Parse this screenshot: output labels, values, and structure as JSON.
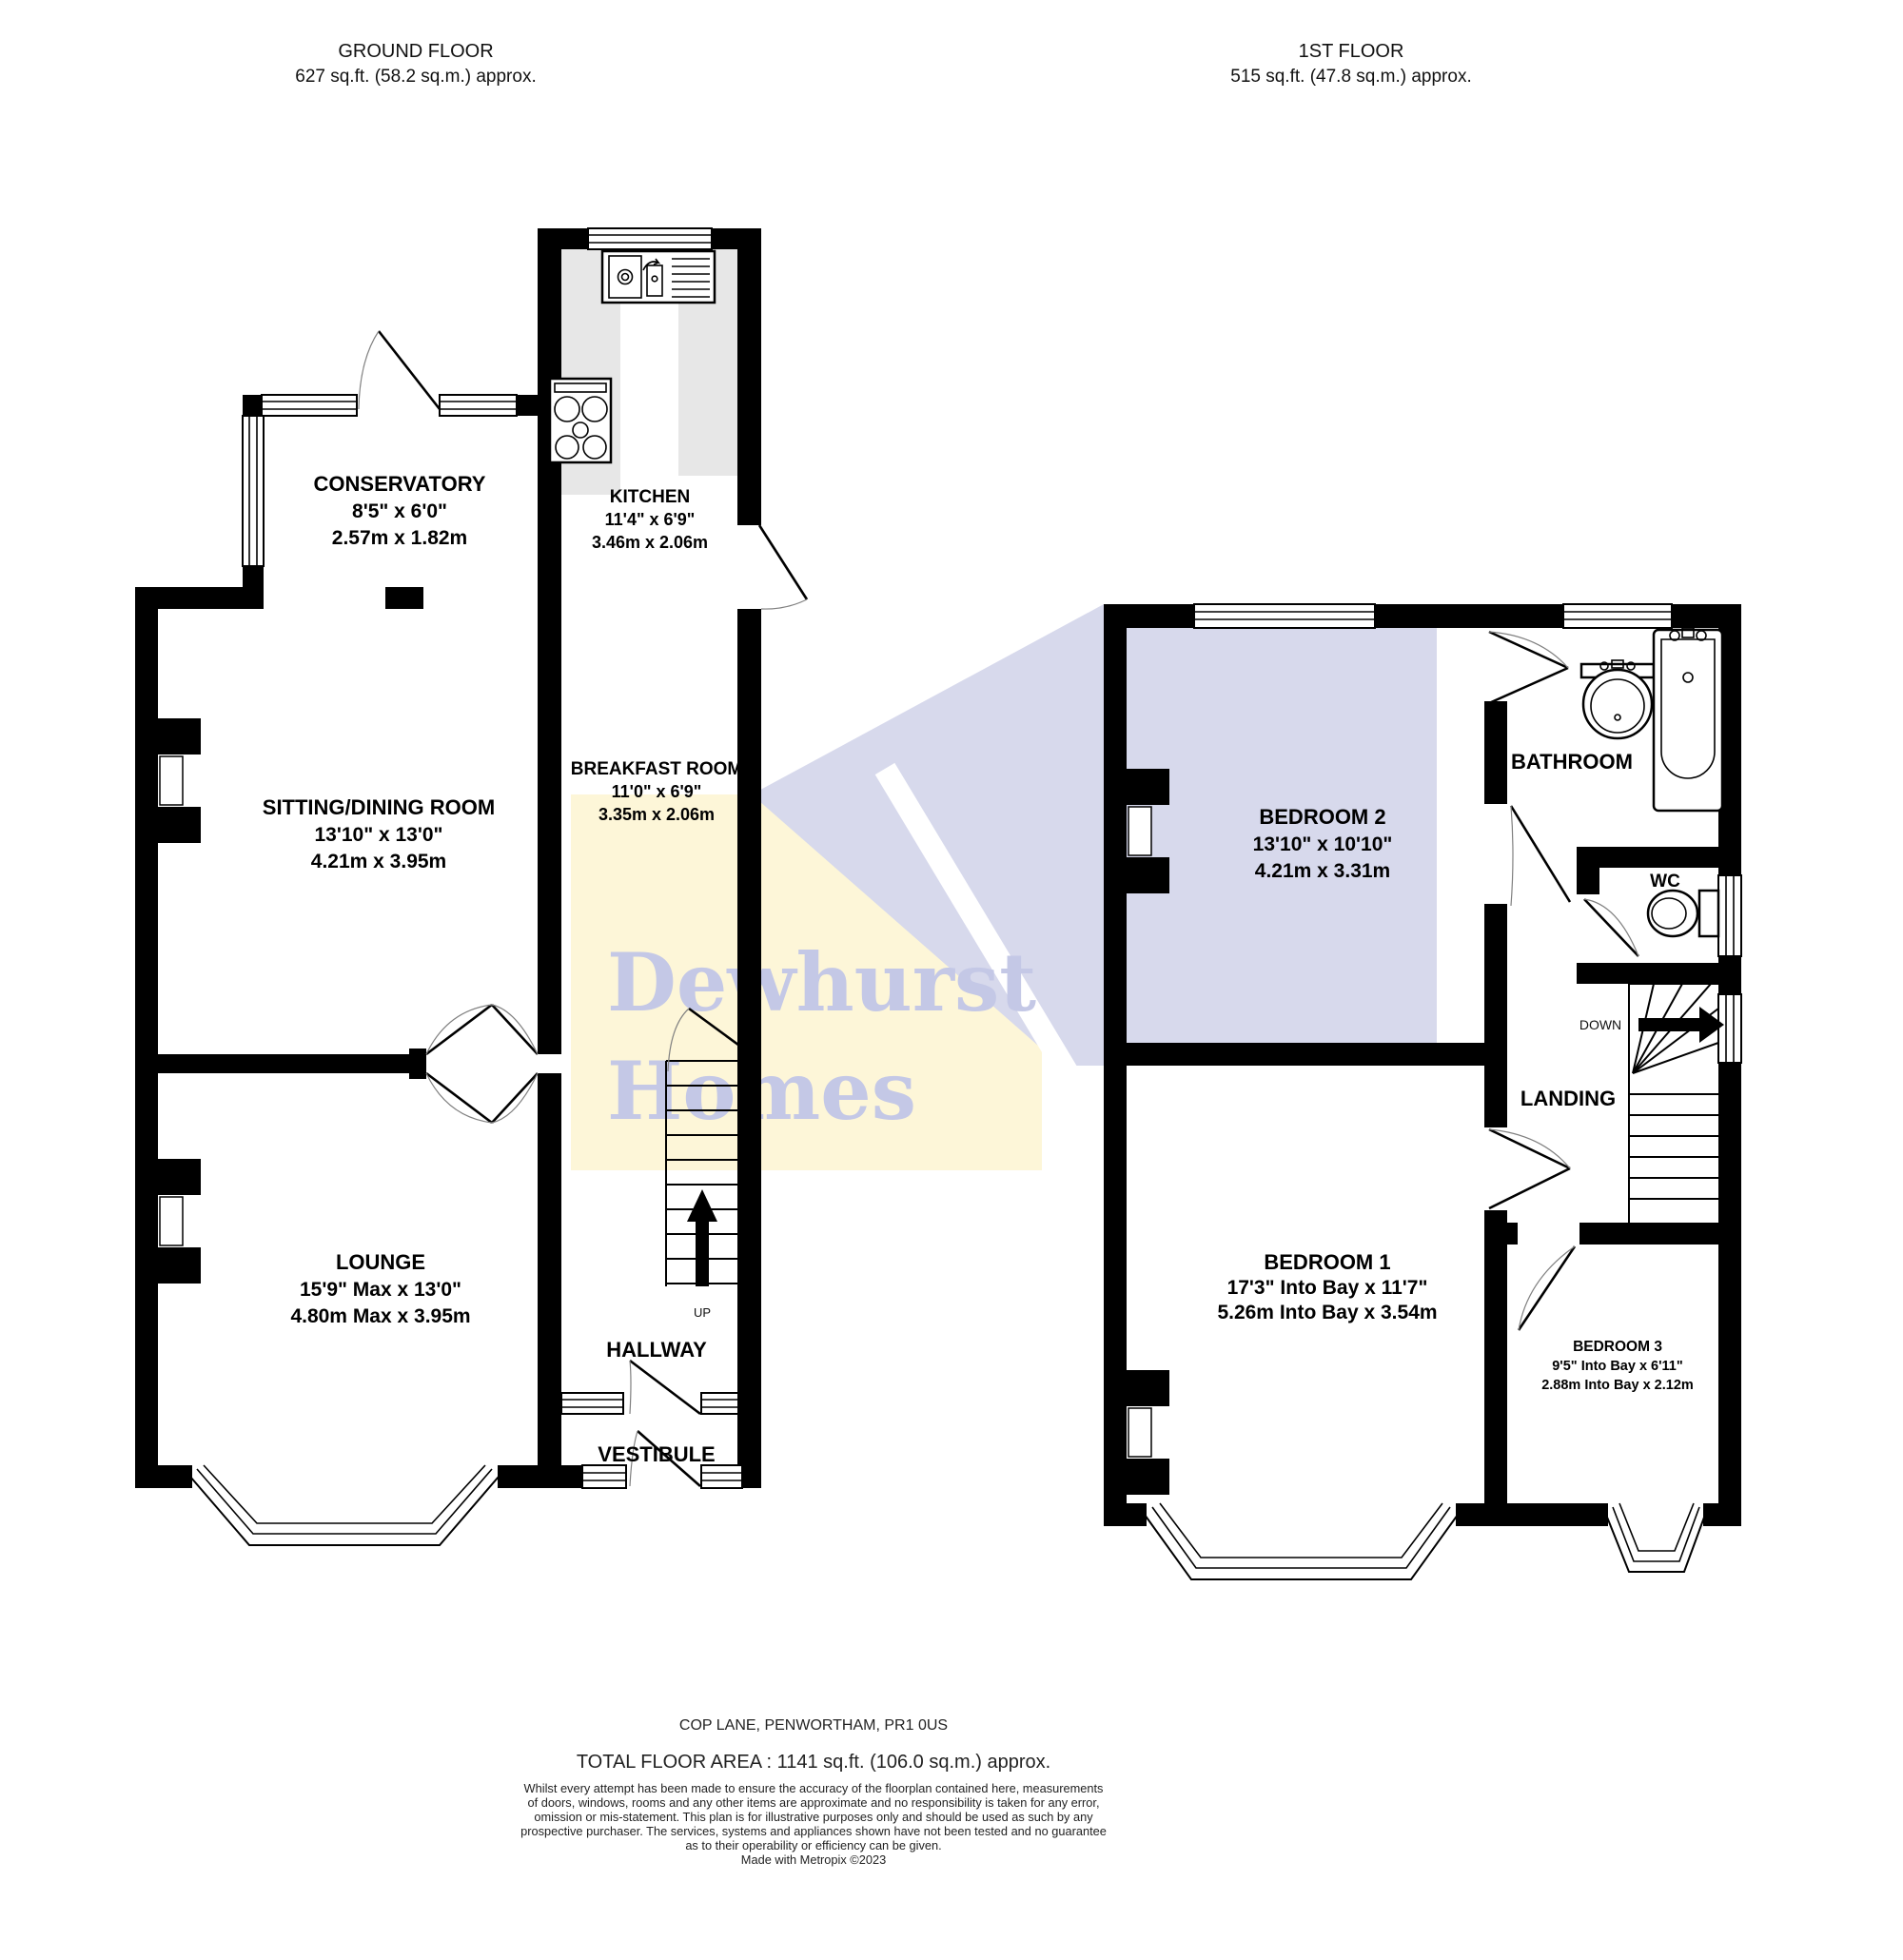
{
  "colors": {
    "wall": "#000000",
    "kitchen_counter": "#e7e7e7",
    "watermark_yellow": "#fdf6d8",
    "watermark_lavender": "#d7d9ec",
    "watermark_text": "#c4c8e6"
  },
  "header": {
    "ground": {
      "title": "GROUND FLOOR",
      "area": "627 sq.ft. (58.2 sq.m.) approx."
    },
    "first": {
      "title": "1ST FLOOR",
      "area": "515 sq.ft. (47.8 sq.m.) approx."
    }
  },
  "ground": {
    "conservatory": {
      "name": "CONSERVATORY",
      "imperial": "8'5\"  x 6'0\"",
      "metric": "2.57m  x 1.82m"
    },
    "kitchen": {
      "name": "KITCHEN",
      "imperial": "11'4\"  x 6'9\"",
      "metric": "3.46m  x 2.06m"
    },
    "sitting": {
      "name": "SITTING/DINING ROOM",
      "imperial": "13'10\"  x 13'0\"",
      "metric": "4.21m  x 3.95m"
    },
    "breakfast": {
      "name": "BREAKFAST ROOM",
      "imperial": "11'0\"  x 6'9\"",
      "metric": "3.35m  x 2.06m"
    },
    "lounge": {
      "name": "LOUNGE",
      "imperial": "15'9\" Max x 13'0\"",
      "metric": "4.80m Max x 3.95m"
    },
    "hallway": {
      "name": "HALLWAY"
    },
    "vestibule": {
      "name": "VESTIBULE"
    },
    "stairs": {
      "label": "UP"
    }
  },
  "first": {
    "bedroom2": {
      "name": "BEDROOM 2",
      "imperial": "13'10\"  x 10'10\"",
      "metric": "4.21m  x 3.31m"
    },
    "bathroom": {
      "name": "BATHROOM"
    },
    "wc": {
      "name": "WC"
    },
    "landing": {
      "name": "LANDING"
    },
    "stairs": {
      "label": "DOWN"
    },
    "bedroom1": {
      "name": "BEDROOM 1",
      "imperial": "17'3\" Into Bay x 11'7\"",
      "metric": "5.26m Into Bay x 3.54m"
    },
    "bedroom3": {
      "name": "BEDROOM 3",
      "imperial": "9'5\" Into Bay x 6'11\"",
      "metric": "2.88m Into Bay x 2.12m"
    }
  },
  "watermark": {
    "line1": "Dewhurst",
    "line2": "Homes"
  },
  "footer": {
    "address": "COP LANE, PENWORTHAM, PR1 0US",
    "total_area": "TOTAL FLOOR AREA : 1141 sq.ft. (106.0 sq.m.) approx.",
    "disclaimer": [
      "Whilst every attempt has been made to ensure the accuracy of the floorplan contained here, measurements",
      "of doors, windows, rooms and any other items are approximate and no responsibility is taken for any error,",
      "omission or mis-statement. This plan is for illustrative purposes only and should be used as such by any",
      "prospective purchaser. The services, systems and appliances shown have not been tested and no guarantee",
      "as to their operability or efficiency can be given."
    ],
    "credit": "Made with Metropix ©2023"
  }
}
